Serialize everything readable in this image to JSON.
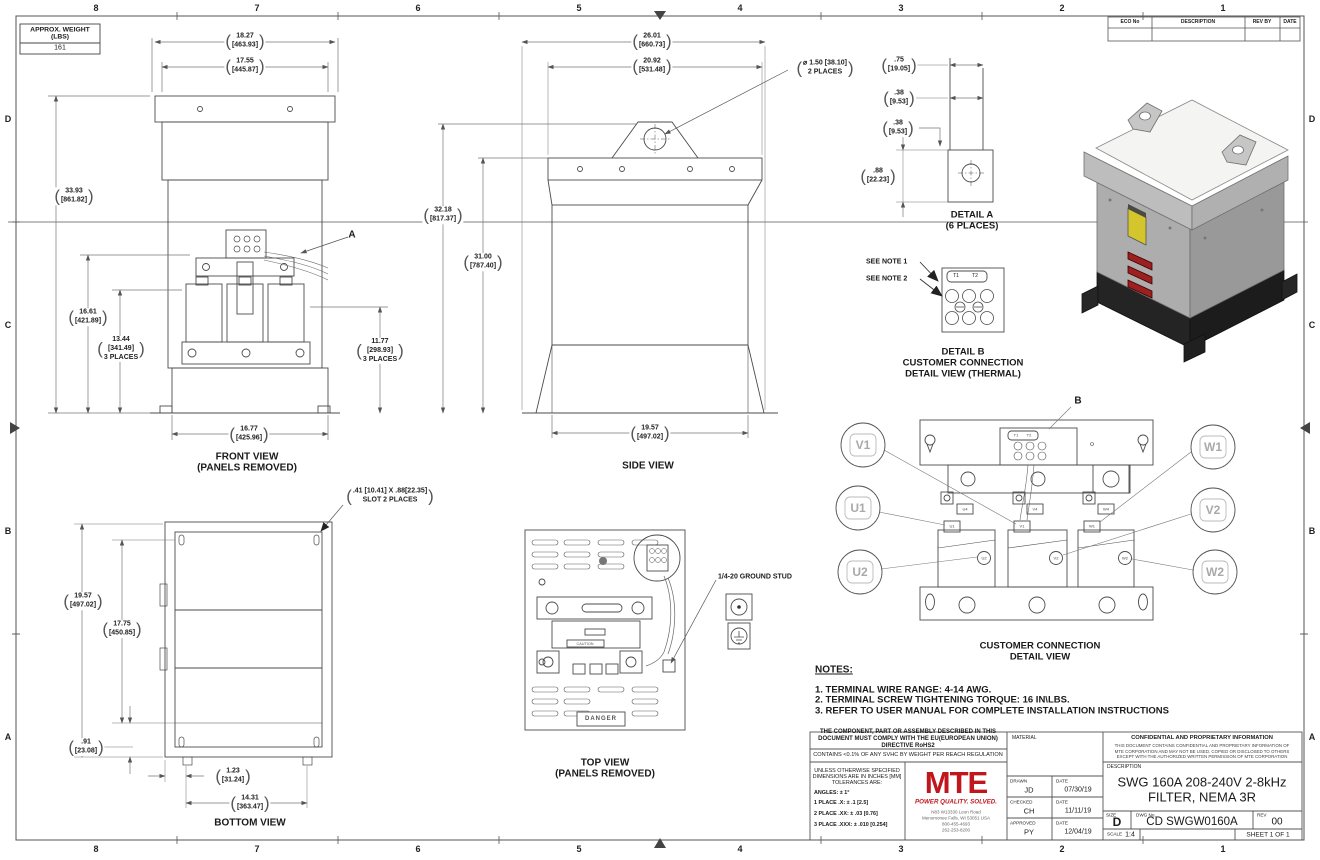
{
  "sheet": {
    "zones_top": [
      "8",
      "7",
      "6",
      "5",
      "4",
      "3",
      "2",
      "1"
    ],
    "zones_bottom": [
      "8",
      "7",
      "6",
      "5",
      "4",
      "3",
      "2",
      "1"
    ],
    "zones_left": [
      "D",
      "C",
      "B",
      "A"
    ],
    "zones_right": [
      "D",
      "C",
      "B",
      "A"
    ],
    "weight_box": {
      "title": "APPROX. WEIGHT",
      "units": "(LBS)",
      "value": "161"
    },
    "eco_table": {
      "col1": "ECO No",
      "col2": "DESCRIPTION",
      "col3": "REV BY",
      "col4": "DATE"
    }
  },
  "colors": {
    "logo_red": "#c1161c",
    "warning_yellow": "#d4c52c",
    "stripe_red": "#9c2020"
  },
  "front_view": {
    "label": "FRONT VIEW",
    "sublabel": "(PANELS REMOVED)",
    "callout": "A",
    "dim_width_outer": {
      "in": "18.27",
      "mm": "[463.93]"
    },
    "dim_width_inner": {
      "in": "17.55",
      "mm": "[445.87]"
    },
    "dim_height_overall": {
      "in": "33.93",
      "mm": "[861.82]"
    },
    "dim_height_terminals": {
      "in": "16.61",
      "mm": "[421.89]"
    },
    "dim_height_coils": {
      "in": "13.44",
      "mm": "[341.49]",
      "note": "3 PLACES"
    },
    "dim_height_right": {
      "in": "11.77",
      "mm": "[298.93]",
      "note": "3 PLACES"
    },
    "dim_width_base": {
      "in": "16.77",
      "mm": "[425.96]"
    }
  },
  "side_view": {
    "label": "SIDE VIEW",
    "dim_depth_outer": {
      "in": "26.01",
      "mm": "[660.73]"
    },
    "dim_depth_top": {
      "in": "20.92",
      "mm": "[531.48]"
    },
    "dim_lift_hole": {
      "line1": "⌀ 1.50 [38.10]",
      "line2": "2 PLACES"
    },
    "dim_height_overall": {
      "in": "32.18",
      "mm": "[817.37]"
    },
    "dim_height_body": {
      "in": "31.00",
      "mm": "[787.40]"
    },
    "dim_depth_base": {
      "in": "19.57",
      "mm": "[497.02]"
    }
  },
  "detail_a": {
    "label": "DETAIL A",
    "sublabel": "(6 PLACES)",
    "dim_1": {
      "in": ".75",
      "mm": "[19.05]"
    },
    "dim_2": {
      "in": ".38",
      "mm": "[9.53]"
    },
    "dim_3": {
      "in": ".38",
      "mm": "[9.53]"
    },
    "dim_4": {
      "in": ".88",
      "mm": "[22.23]"
    }
  },
  "detail_b": {
    "label": "DETAIL B",
    "sublabel1": "CUSTOMER CONNECTION",
    "sublabel2": "DETAIL VIEW (THERMAL)",
    "see_note_1": "SEE NOTE 1",
    "see_note_2": "SEE NOTE 2",
    "t1": "T1",
    "t2": "T2"
  },
  "top_view": {
    "label": "TOP VIEW",
    "sublabel": "(PANELS REMOVED)",
    "ground_stud_callout": "1/4-20 GROUND STUD",
    "danger_label": "DANGER",
    "caution_label": "CAUTION"
  },
  "bottom_view": {
    "label": "BOTTOM VIEW",
    "slot_callout": {
      "line1": ".41 [10.41]  X .88[22.35]",
      "line2": "SLOT 2 PLACES"
    },
    "dim_depth_outer": {
      "in": "19.57",
      "mm": "[497.02]"
    },
    "dim_depth_inner": {
      "in": "17.75",
      "mm": "[450.85]"
    },
    "dim_offset": {
      "in": ".91",
      "mm": "[23.08]"
    },
    "dim_foot": {
      "in": "1.23",
      "mm": "[31.24]"
    },
    "dim_width_feet": {
      "in": "14.31",
      "mm": "[363.47]"
    }
  },
  "connection_view": {
    "label": "CUSTOMER CONNECTION",
    "sublabel": "DETAIL VIEW",
    "callout": "B",
    "balloon_v1": "V1",
    "balloon_u1": "U1",
    "balloon_u2": "U2",
    "balloon_w1": "W1",
    "balloon_v2": "V2",
    "balloon_w2": "W2",
    "tag_u4": "U4",
    "tag_v4": "V4",
    "tag_w4": "W4",
    "tag_u1": "U1",
    "tag_v1": "V1",
    "tag_w1": "W1",
    "tag_u2": "U2",
    "tag_v2": "V2",
    "tag_w2": "W2",
    "tag_t1": "T1",
    "tag_t2": "T2"
  },
  "notes": {
    "title": "NOTES:",
    "item1": "1.  TERMINAL WIRE RANGE: 4-14 AWG.",
    "item2": "2.  TERMINAL SCREW TIGHTENING TORQUE: 16 IN\\LBS.",
    "item3": "3.  REFER TO USER MANUAL FOR COMPLETE INSTALLATION INSTRUCTIONS"
  },
  "title_block": {
    "compliance": "THE COMPONENT, PART OR ASSEMBLY DESCRIBED IN THIS DOCUMENT MUST COMPLY WITH THE EU(EUROPEAN UNION) DIRECTIVE RoHS2",
    "reach": "CONTAINS <0.1% OF ANY SVHC BY WEIGHT PER REACH REGULATION",
    "tol_header1": "UNLESS OTHERWISE SPECIFIED",
    "tol_header2": "DIMENSIONS ARE IN INCHES [MM]",
    "tol_header3": "TOLERANCES ARE:",
    "tol_angles": "ANGLES:  ± 1°",
    "tol_1place": "1 PLACE .X:   ± .1 [2.5]",
    "tol_2place": "2 PLACE .XX:   ± .03 [0.76]",
    "tol_3place": "3 PLACE .XXX:   ± .010 [0.254]",
    "logo_text": "MTE",
    "logo_tagline": "POWER QUALITY. SOLVED.",
    "address_line1": "N83 W13330 Leon Road",
    "address_line2": "Menomonee Falls, WI 53051 USA",
    "address_line3": "800-455-4693",
    "address_line4": "262-253-8200",
    "material_label": "MATERIAL",
    "drawn_label": "DRAWN",
    "drawn_value": "JD",
    "drawn_date_label": "DATE",
    "drawn_date": "07/30/19",
    "checked_label": "CHECKED",
    "checked_value": "CH",
    "checked_date_label": "DATE",
    "checked_date": "11/11/19",
    "approved_label": "APPROVED",
    "approved_value": "PY",
    "approved_date_label": "DATE",
    "approved_date": "12/04/19",
    "confidential_title": "CONFIDENTIAL AND PROPRIETARY INFORMATION",
    "confidential_body": "THIS DOCUMENT CONTAINS CONFIDENTIAL AND PROPRIETARY INFORMATION OF MTE CORPORATION AND MAY NOT BE USED, COPIED OR DISCLOSED TO OTHERS EXCEPT WITH THE AUTHORIZED WRITTEN PERMISSION OF MTE CORPORATION",
    "description_label": "DESCRIPTION",
    "description_line1": "SWG 160A 208-240V 2-8kHz",
    "description_line2": "FILTER, NEMA 3R",
    "size_label": "SIZE",
    "size_value": "D",
    "dwg_label": "DWG No.",
    "dwg_value": "CD SWGW0160A",
    "rev_label": "REV",
    "rev_value": "00",
    "scale_label": "SCALE",
    "scale_value": "1:4",
    "sheet_value": "SHEET 1  OF 1"
  }
}
